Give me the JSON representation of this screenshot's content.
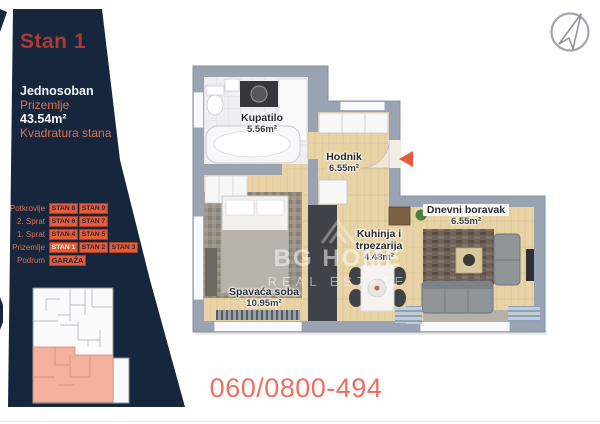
{
  "colors": {
    "panel_navy": "#16263c",
    "accent_orange": "#e85b36",
    "salmon": "#dd7257",
    "title_red": "#ac3a30",
    "phone_red": "#ee6f60",
    "wall_gray": "#9aa3b2",
    "wood": "#e7d3a6",
    "highlight_salmon": "#f2a68f"
  },
  "sidebar": {
    "title": "Stan 1",
    "type": "Jednosoban",
    "floor": "Prizemlje",
    "area": "43.54m²",
    "area_caption": "Kvadratura stana",
    "floors": [
      {
        "label": "Potkrovlje",
        "units": [
          "STAN 8",
          "STAN 9"
        ]
      },
      {
        "label": "2. Sprat",
        "units": [
          "STAN 6",
          "STAN 7"
        ]
      },
      {
        "label": "1. Sprat",
        "units": [
          "STAN 4",
          "STAN 5"
        ]
      },
      {
        "label": "Prizemlje",
        "units": [
          "STAN 1",
          "STAN 2",
          "STAN 3"
        ],
        "active_unit": "STAN 1"
      },
      {
        "label": "Podrum",
        "units": [
          "GARAŽA"
        ]
      }
    ]
  },
  "floorplan": {
    "rooms": {
      "kupatilo": {
        "name": "Kupatilo",
        "area": "5.56m²"
      },
      "hodnik": {
        "name": "Hodnik",
        "area": "6.55m²"
      },
      "dnevni": {
        "name": "Dnevni boravak",
        "area": "6.55m²"
      },
      "kuhinja": {
        "name_line1": "Kuhinja i",
        "name_line2": "trpezarija",
        "area": "4.48m²"
      },
      "spavaca": {
        "name": "Spavaća soba",
        "area": "10.95m²"
      }
    },
    "icons": [
      "entry-arrow",
      "compass-north-arrow"
    ]
  },
  "watermark": {
    "line1": "BG HOME",
    "line2": "REAL ESTATE"
  },
  "phone": "060/0800-494"
}
